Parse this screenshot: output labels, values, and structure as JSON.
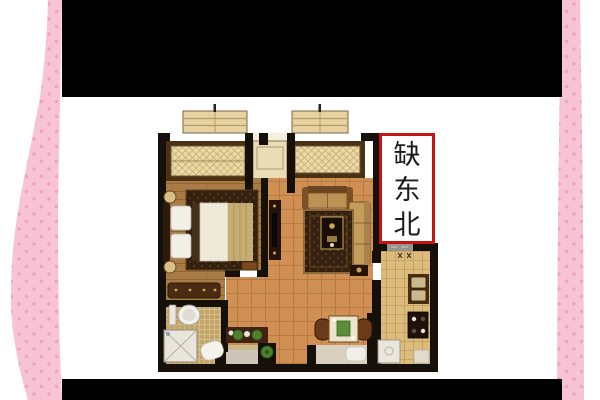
{
  "annotation": {
    "text": "缺东北",
    "chars": [
      "缺",
      "东",
      "北"
    ]
  },
  "colors": {
    "background": "#ffffff",
    "letterbox": "#000000",
    "side_band": "#f9c3d6",
    "side_band_dot": "#eda4c1",
    "annotation_border": "#c41414",
    "annotation_text": "#1c1c1c",
    "wall": "#16100a",
    "wood_floor": "#a87c44",
    "tile_floor": "#d09054",
    "kitchen_tile": "#dcbc7c",
    "bathroom_tile": "#c2a567",
    "window_fill": "#ead9a8",
    "window_frame": "#4a3114",
    "balcony": "#e6d2a2"
  }
}
